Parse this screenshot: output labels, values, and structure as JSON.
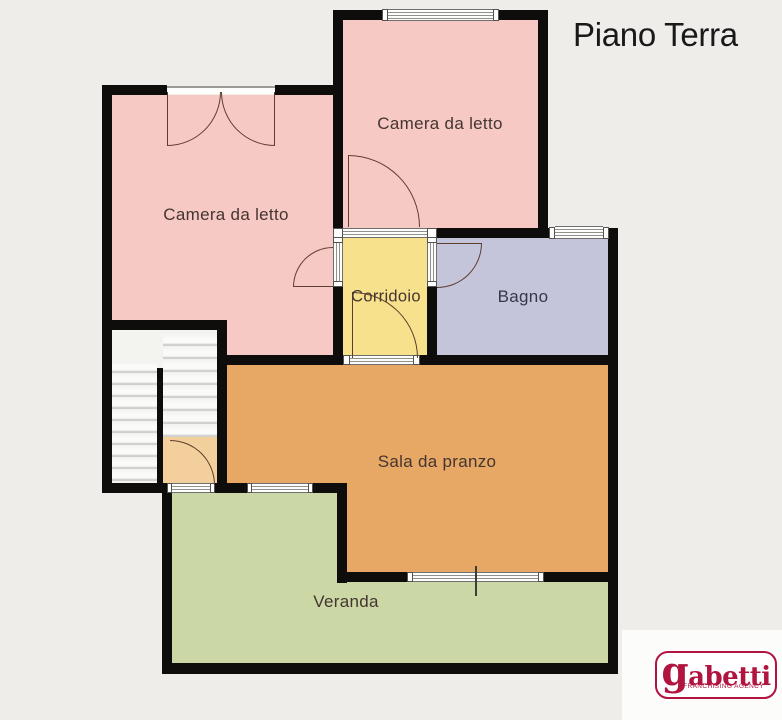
{
  "header": {
    "title": "Piano Terra"
  },
  "rooms": {
    "bedroom_top": {
      "label": "Camera da letto",
      "color": "#f7c9c4"
    },
    "bedroom_left": {
      "label": "Camera da letto",
      "color": "#f7c9c4"
    },
    "corridor": {
      "label": "Corridoio",
      "color": "#f8e18d"
    },
    "bathroom": {
      "label": "Bagno",
      "color": "#c4c4db"
    },
    "dining_room": {
      "label": "Sala da pranzo",
      "color": "#e7a765"
    },
    "veranda": {
      "label": "Veranda",
      "color": "#cbd8a6"
    },
    "stairwell": {
      "color": "#f3f3f0"
    },
    "entry_vestibule": {
      "color": "#f3cf9c"
    }
  },
  "logo": {
    "brand_lead": "g",
    "brand_rest": "abetti",
    "tagline": "FRANCHISING AGENCY",
    "accent_color": "#b0143f"
  },
  "palette": {
    "background": "#efedea",
    "wall": "#0f0d0b",
    "door_arc": "#5f3d2e",
    "window_stripe": "#7d7d7a",
    "label_text": "#443530",
    "title_text": "#191919"
  }
}
